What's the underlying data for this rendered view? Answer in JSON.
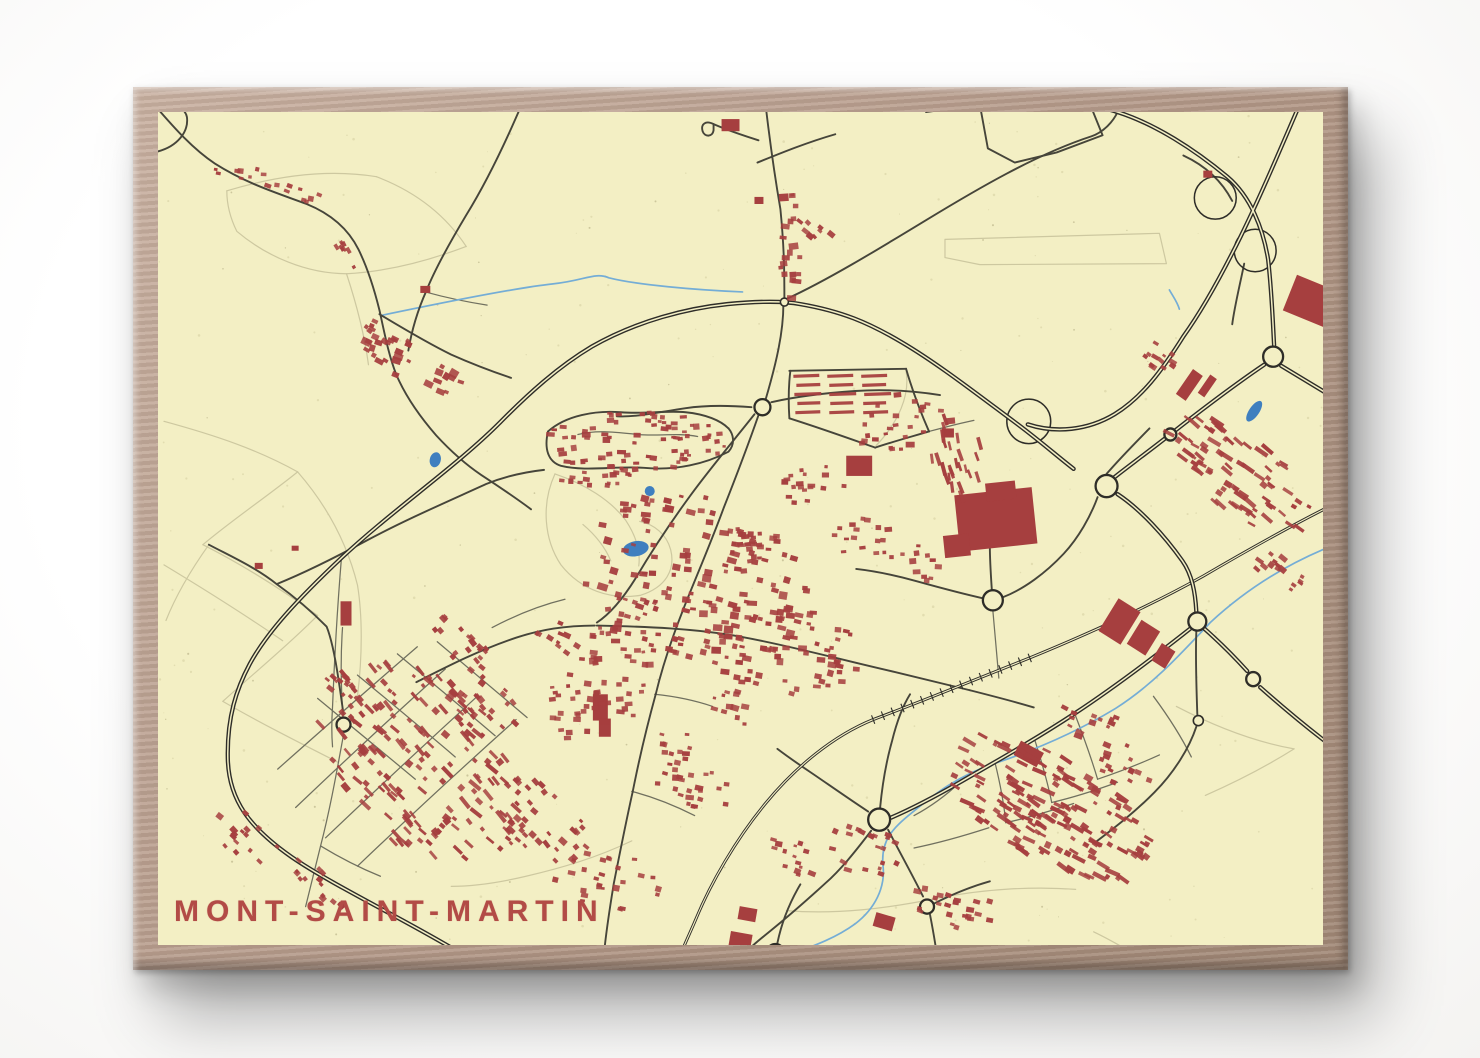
{
  "poster": {
    "title": "MONT-SAINT-MARTIN",
    "palette": {
      "paper": "#f3efc4",
      "speckle_light": "#ddd8ab",
      "speckle_dark": "#bcb78c",
      "building": "#a63f3f",
      "title_color": "#b24b46",
      "road_major": "#2e2d28",
      "road_medium": "#46453a",
      "road_minor": "#70705f",
      "path_faint": "#cdc8a0",
      "water_fill": "#3f7fbf",
      "water_line": "#74add6",
      "frame_wood": "#b59c8c"
    }
  },
  "map": {
    "seed": 12345,
    "roads_major": [
      "M 470,947 C 420,916 337,877 296,849 C 254,820 233,793 232,752 C 231,710 241,682 254,658 C 271,627 302,594 346,553 C 398,505 462,462 506,418 C 533,391 563,364 597,344 C 643,318 694,306 733,302 C 765,299 790,299 806,302 C 847,309 874,320 908,340 C 944,361 983,391 1024,421 C 1047,438 1063,452 1080,465",
      "M 1124,490 C 1147,505 1171,531 1189,556 C 1199,570 1202,588 1203,606",
      "M 1309,99 C 1288,147 1267,196 1247,236 C 1227,276 1206,312 1190,334 C 1169,367 1149,394 1121,411 C 1094,427 1062,430 1034,421",
      "M 1048,91 C 1076,99 1101,105 1124,112 C 1162,124 1201,149 1234,176 C 1258,196 1270,228 1275,258 C 1279,294 1280,327 1281,343",
      "M 1288,363 C 1308,375 1328,387 1345,397",
      "M 1271,362 C 1241,382 1209,406 1178,430 C 1147,454 1127,468 1115,478",
      "M 1211,623 C 1227,637 1243,653 1254,665",
      "M 1267,681 C 1291,702 1319,725 1345,744",
      "M 1197,623 C 1161,651 1121,681 1081,707 C 1041,733 1001,755 966,775 C 936,792 911,804 897,810"
    ],
    "roads_medium": [
      "M 770,95 C 774,130 779,168 786,208 C 790,248 790,272 790,299",
      "M 789,302 C 789,330 782,360 771,397",
      "M 764,412 C 752,446 741,474 729,504 C 716,539 701,573 689,603 C 677,633 668,659 661,688 C 651,724 644,754 638,784 C 631,815 625,845 619,875 C 614,905 611,925 609,946",
      "M 760,411 C 740,436 716,464 696,491 C 676,518 656,548 641,573 C 629,592 616,608 602,617",
      "M 602,620 C 652,621 701,623 746,631 C 801,641 851,655 901,666 C 931,673 956,679 976,684",
      "M 976,684 C 1000,690 1020,695 1040,701",
      "M 600,620 C 570,620 546,624 521,632 C 482,645 451,661 421,676",
      "M 777,399 C 800,394 830,390 861,388 C 891,386 920,388 946,392",
      "M 757,404 C 731,402 711,402 691,405 C 663,409 643,414 622,413",
      "M 553,428 C 571,412 601,407 626,409 C 651,411 671,407 691,409 C 711,411 726,417 734,425",
      "M 553,428 C 549,445 553,458 566,462 C 591,468 621,462 649,464 C 681,467 711,460 734,448 C 741,440 739,431 734,425",
      "M 161,108 C 176,125 196,148 219,163 C 251,183 281,192 311,203 C 336,213 353,228 363,248 C 373,268 379,288 384,308 C 389,330 393,352 401,372 C 411,395 426,415 441,432 C 456,448 471,461 486,471 C 503,482 521,494 536,505",
      "M 384,312 C 406,325 431,340 456,352 C 481,363 501,370 516,375",
      "M 532,92 C 516,130 496,174 471,214 C 451,247 439,269 431,289 C 421,311 416,330 413,348",
      "M 213,540 C 236,552 259,562 281,579 C 301,593 316,606 331,621 C 339,640 344,680 348,708",
      "M 281,579 C 311,567 341,552 371,536 C 411,515 451,498 491,480 C 511,472 531,468 549,466",
      "M 162,151 C 181,146 193,132 191,117 C 189,107 176,103 165,106",
      "M 792,297 C 832,279 882,249 932,219 C 982,189 1042,154 1098,136 C 1110,132 1120,121 1124,112",
      "M 986,105 L 1041,88 L 1093,96 L 1109,135 L 1063,152 L 1021,162 L 994,148 Z",
      "M 986,105 L 932,112",
      "M 764,140 C 748,135 733,130 719,124",
      "M 719,124 C 711,120 706,124 708,131 C 710,137 718,137 719,130 Z",
      "M 763,162 C 788,152 813,142 841,134",
      "M 886,800 C 888,779 892,755 898,734 C 903,714 909,699 916,688",
      "M 874,804 C 851,789 831,775 816,765 C 801,755 791,748 783,742",
      "M 877,823 C 860,845 846,862 831,875 C 811,893 791,910 776,922 C 766,930 756,938 749,945",
      "M 894,822 C 906,845 919,868 929,888",
      "M 936,906 C 939,921 941,933 943,946",
      "M 940,895 C 960,885 978,878 996,873",
      "M 783,934 C 787,915 794,896 806,876",
      "M 1203,626 C 1202,652 1203,680 1204,708",
      "M 1203,720 C 1196,741 1181,765 1161,785 C 1141,805 1121,820 1101,835",
      "M 1009,592 C 1030,584 1052,568 1070,549 C 1085,533 1097,512 1104,493",
      "M 989,593 C 966,588 944,582 922,576 C 900,570 880,566 862,564",
      "M 996,542 C 996,556 997,570 998,585",
      "M 795,368 L 912,366",
      "M 912,366 C 919,390 927,410 935,428",
      "M 795,415 C 830,426 858,436 881,444",
      "M 881,444 C 899,438 918,433 935,428",
      "M 796,368 C 794,384 794,400 795,415",
      "M 1113,470 C 1126,455 1141,440 1156,425",
      "M 1190,155 C 1214,166 1229,181 1239,200",
      "M 1251,262 C 1246,286 1241,306 1239,322"
    ],
    "roads_minor": [
      "M 583,431 C 603,426 623,429 643,431 C 663,433 683,429 703,433",
      "M 300,800 C 350,753 400,707 450,663",
      "M 330,830 C 380,783 430,737 481,691",
      "M 362,858 C 412,811 462,765 521,713",
      "M 282,762 C 322,727 362,692 422,641",
      "M 322,692 C 355,719 388,746 420,772",
      "M 362,669 C 395,696 428,723 460,750",
      "M 402,648 C 435,675 468,702 500,729",
      "M 442,636 C 472,661 502,686 532,711",
      "M 348,718 C 345,680 345,650 347,622",
      "M 348,728 C 342,760 335,800 325,838 C 320,858 315,878 310,898",
      "M 325,838 C 345,850 365,860 385,868",
      "M 497,622 C 520,610 545,600 570,594",
      "M 346,552 C 342,600 339,650 337,700 C 336,715 336,728 337,740",
      "M 430,290 C 452,296 472,300 492,303",
      "M 1081,707 C 1090,730 1098,752 1104,772",
      "M 1041,733 C 1048,755 1054,775 1058,795",
      "M 1001,755 C 1006,775 1010,795 1012,815",
      "M 966,775 C 950,790 935,800 920,808",
      "M 1104,772 C 1125,765 1146,757 1166,748",
      "M 1058,795 C 1080,790 1102,783 1124,775",
      "M 1012,815 C 1035,810 1058,803 1080,796",
      "M 920,840 C 945,835 970,828 995,820",
      "M 1160,690 C 1175,710 1188,730 1198,750",
      "M 660,688 C 680,690 700,694 718,700",
      "M 637,784 C 660,790 680,798 700,808",
      "M 999,605 C 1001,628 1003,650 1005,672",
      "M 935,428 C 950,424 965,420 980,417"
    ],
    "paths_faint": [
      "M 231,190 C 281,175 331,168 381,176",
      "M 381,176 C 421,191 451,215 471,245",
      "M 471,245 C 431,260 391,270 351,272",
      "M 351,272 C 311,272 271,255 241,230 C 234,216 231,202 231,190",
      "M 351,272 C 361,302 369,332 373,362",
      "M 168,418 C 220,432 262,446 302,468",
      "M 302,468 C 272,492 237,515 207,540",
      "M 207,540 C 247,560 287,585 322,610",
      "M 322,610 C 292,640 257,668 227,695",
      "M 227,695 C 262,715 302,735 342,755",
      "M 168,560 C 210,585 250,610 287,635",
      "M 302,468 C 332,502 352,540 362,580 C 367,610 367,650 362,690",
      "M 213,540 C 195,565 180,590 170,615",
      "M 951,238 L 1166,232 L 1173,262 L 986,263 L 951,256 Z",
      "M 560,470 C 590,480 616,496 631,516 C 641,531 646,546 644,561",
      "M 560,470 C 546,500 549,535 566,560 C 586,585 616,595 646,590 C 671,582 681,565 676,545 C 672,530 660,520 645,517",
      "M 588,520 C 600,530 610,542 616,556",
      "M 637,833 C 601,850 566,860 531,868 C 501,875 476,878 456,878",
      "M 1100,923 C 1115,930 1129,938 1143,946",
      "M 792,902 C 842,906 892,900 942,890 C 992,880 1042,878 1082,881",
      "M 1183,700 C 1222,720 1261,735 1301,742",
      "M 1301,742 C 1272,760 1242,775 1212,788",
      "M 912,368 C 916,392 905,418 882,442"
    ],
    "streams": [
      "M 387,313 C 450,300 520,286 558,282 C 589,279 600,270 614,276 C 642,283 700,288 748,290",
      "M 1337,542 C 1292,560 1252,585 1217,617 C 1182,654 1157,680 1122,702 C 1087,723 1047,741 1002,756 C 962,769 938,789 918,805 C 898,821 886,833 889,859 C 891,879 881,900 861,915 C 836,933 806,941 789,948",
      "M 1176,288 C 1180,295 1184,300 1186,307"
    ],
    "railway": {
      "d": "M 1345,498 C 1300,520 1255,545 1210,571 C 1163,597 1100,626 1036,652 C 980,674 925,696 879,713 C 839,729 801,760 771,796 C 741,832 716,875 701,911 C 695,925 689,937 685,948",
      "hatch_from": [
        1036,
        652
      ],
      "hatch_to": [
        879,
        713
      ],
      "ticks": 16
    },
    "roundabouts": [
      [
        790,
        300,
        4
      ],
      [
        768,
        404,
        8
      ],
      [
        1113,
        482,
        11
      ],
      [
        999,
        595,
        10
      ],
      [
        1280,
        354,
        10
      ],
      [
        1177,
        431,
        6
      ],
      [
        1204,
        616,
        9
      ],
      [
        1260,
        673,
        7
      ],
      [
        1205,
        714,
        5
      ],
      [
        885,
        812,
        11
      ],
      [
        933,
        898,
        7
      ],
      [
        781,
        944,
        9
      ],
      [
        348,
        718,
        7
      ]
    ],
    "loops": [
      [
        1222,
        197,
        21
      ],
      [
        1262,
        249,
        21
      ],
      [
        1035,
        418,
        22
      ]
    ],
    "ponds": [
      {
        "cx": 440,
        "cy": 456,
        "rx": 5.5,
        "ry": 7.5,
        "rot": 15
      },
      {
        "cx": 655,
        "cy": 487,
        "rx": 5,
        "ry": 5,
        "rot": 0
      },
      {
        "cx": 641,
        "cy": 544,
        "rx": 13,
        "ry": 7.5,
        "rot": -10
      },
      {
        "cx": 1261,
        "cy": 408,
        "rx": 5,
        "ry": 12,
        "rot": 35
      }
    ],
    "big_buildings": [
      [
        963,
        487,
        78,
        56,
        -6
      ],
      [
        992,
        478,
        30,
        18,
        -6
      ],
      [
        950,
        530,
        26,
        22,
        -6
      ],
      [
        1295,
        281,
        50,
        38,
        22
      ],
      [
        1190,
        367,
        12,
        30,
        35
      ],
      [
        1210,
        372,
        8,
        22,
        35
      ],
      [
        1113,
        597,
        26,
        38,
        32
      ],
      [
        1139,
        618,
        22,
        28,
        32
      ],
      [
        1162,
        640,
        16,
        20,
        32
      ],
      [
        852,
        452,
        26,
        20,
        0
      ],
      [
        727,
        119,
        18,
        12,
        0
      ],
      [
        598,
        688,
        15,
        26,
        0
      ],
      [
        604,
        712,
        12,
        18,
        0
      ],
      [
        345,
        596,
        11,
        24,
        0
      ],
      [
        1022,
        739,
        26,
        16,
        28
      ],
      [
        880,
        906,
        20,
        14,
        16
      ],
      [
        744,
        899,
        18,
        13,
        10
      ],
      [
        735,
        924,
        22,
        15,
        10
      ],
      [
        259,
        558,
        8,
        6,
        0
      ],
      [
        296,
        541,
        7,
        5,
        0
      ],
      [
        425,
        284,
        10,
        7,
        0
      ],
      [
        760,
        196,
        9,
        7,
        0
      ],
      [
        1210,
        170,
        9,
        7,
        0
      ],
      [
        948,
        425,
        12,
        9,
        0
      ]
    ],
    "bar_rows": [
      {
        "x": 799,
        "y": 373,
        "count": 3,
        "len": 26,
        "th": 3.2,
        "step": 34,
        "rot": -2
      },
      {
        "x": 802,
        "y": 382,
        "count": 3,
        "len": 24,
        "th": 3.2,
        "step": 33,
        "rot": -2
      },
      {
        "x": 800,
        "y": 391,
        "count": 3,
        "len": 27,
        "th": 3.2,
        "step": 35,
        "rot": -2
      },
      {
        "x": 803,
        "y": 400,
        "count": 3,
        "len": 23,
        "th": 3.2,
        "step": 33,
        "rot": -2
      },
      {
        "x": 801,
        "y": 409,
        "count": 3,
        "len": 25,
        "th": 3.2,
        "step": 34,
        "rot": -2
      }
    ],
    "clusters": [
      [
        415,
        362,
        58,
        16,
        25,
        26,
        3,
        6,
        25,
        0
      ],
      [
        300,
        192,
        30,
        7,
        15,
        9,
        2.5,
        4.5,
        15,
        0
      ],
      [
        795,
        243,
        12,
        55,
        0,
        20,
        3,
        5.5,
        0,
        0
      ],
      [
        818,
        220,
        26,
        14,
        40,
        8,
        3,
        5,
        40,
        0
      ],
      [
        640,
        438,
        92,
        30,
        0,
        80,
        2.6,
        4.6,
        0,
        0
      ],
      [
        600,
        470,
        40,
        12,
        0,
        16,
        2.6,
        4.2,
        0,
        0
      ],
      [
        700,
        575,
        115,
        85,
        15,
        140,
        2.8,
        5.5,
        10,
        0
      ],
      [
        790,
        645,
        80,
        45,
        10,
        65,
        2.8,
        5.2,
        10,
        0
      ],
      [
        618,
        660,
        40,
        60,
        0,
        40,
        2.8,
        5,
        0,
        0
      ],
      [
        425,
        755,
        120,
        80,
        42,
        85,
        2.6,
        4.6,
        45,
        1
      ],
      [
        435,
        760,
        120,
        80,
        42,
        75,
        2.6,
        4.8,
        45,
        0
      ],
      [
        545,
        815,
        55,
        35,
        40,
        36,
        2.6,
        4.6,
        45,
        0
      ],
      [
        1055,
        800,
        115,
        55,
        28,
        100,
        2.6,
        5,
        30,
        1
      ],
      [
        1060,
        805,
        110,
        50,
        28,
        65,
        2.6,
        5,
        30,
        0
      ],
      [
        1245,
        470,
        85,
        40,
        35,
        50,
        2.6,
        5,
        35,
        1
      ],
      [
        1250,
        475,
        80,
        35,
        35,
        28,
        2.8,
        5,
        35,
        0
      ],
      [
        1285,
        560,
        35,
        20,
        35,
        15,
        2.6,
        4.6,
        35,
        0
      ],
      [
        352,
        690,
        35,
        18,
        40,
        18,
        2.6,
        4.4,
        45,
        0
      ],
      [
        612,
        872,
        55,
        28,
        10,
        26,
        2.6,
        4.8,
        10,
        0
      ],
      [
        905,
        420,
        55,
        30,
        0,
        28,
        2.6,
        4.6,
        0,
        0
      ],
      [
        962,
        452,
        42,
        28,
        75,
        24,
        2.6,
        4.4,
        75,
        1
      ],
      [
        1160,
        350,
        28,
        13,
        35,
        12,
        2.6,
        4.4,
        35,
        0
      ],
      [
        700,
        782,
        38,
        22,
        10,
        22,
        2.6,
        4.6,
        10,
        0
      ],
      [
        870,
        842,
        38,
        26,
        20,
        20,
        2.6,
        4.6,
        20,
        0
      ],
      [
        962,
        900,
        48,
        22,
        15,
        22,
        2.6,
        4.6,
        15,
        0
      ],
      [
        1100,
        722,
        38,
        22,
        25,
        16,
        2.6,
        4.6,
        25,
        0
      ],
      [
        252,
        832,
        38,
        22,
        40,
        16,
        2.6,
        4.4,
        45,
        0
      ],
      [
        322,
        880,
        38,
        18,
        40,
        14,
        2.6,
        4.4,
        45,
        0
      ],
      [
        468,
        640,
        48,
        16,
        40,
        20,
        2.6,
        4.4,
        45,
        0
      ],
      [
        580,
        700,
        28,
        38,
        0,
        22,
        2.6,
        4.6,
        0,
        0
      ],
      [
        488,
        700,
        40,
        30,
        40,
        26,
        2.6,
        4.6,
        45,
        0
      ],
      [
        390,
        330,
        30,
        10,
        30,
        10,
        2.6,
        4.2,
        30,
        0
      ],
      [
        755,
        540,
        22,
        30,
        0,
        18,
        2.6,
        4.6,
        0,
        0
      ],
      [
        820,
        480,
        30,
        25,
        0,
        18,
        2.6,
        4.6,
        0,
        0
      ],
      [
        870,
        530,
        30,
        25,
        0,
        16,
        2.6,
        4.6,
        0,
        0
      ],
      [
        920,
        560,
        30,
        20,
        0,
        12,
        2.6,
        4.6,
        0,
        0
      ],
      [
        1130,
        760,
        30,
        20,
        25,
        12,
        2.6,
        4.6,
        25,
        0
      ],
      [
        795,
        850,
        30,
        20,
        15,
        14,
        2.6,
        4.6,
        15,
        0
      ],
      [
        680,
        740,
        25,
        18,
        10,
        12,
        2.6,
        4.6,
        10,
        0
      ],
      [
        740,
        700,
        25,
        18,
        10,
        12,
        2.6,
        4.6,
        10,
        0
      ],
      [
        245,
        172,
        28,
        8,
        10,
        8,
        2.4,
        4,
        10,
        0
      ],
      [
        352,
        258,
        20,
        8,
        60,
        8,
        2.4,
        4,
        60,
        0
      ],
      [
        640,
        600,
        25,
        15,
        15,
        10,
        2.6,
        4.4,
        15,
        0
      ],
      [
        560,
        630,
        25,
        15,
        30,
        10,
        2.6,
        4.4,
        30,
        0
      ]
    ],
    "speckles": {
      "light_count": 260,
      "dark_count": 70
    }
  }
}
